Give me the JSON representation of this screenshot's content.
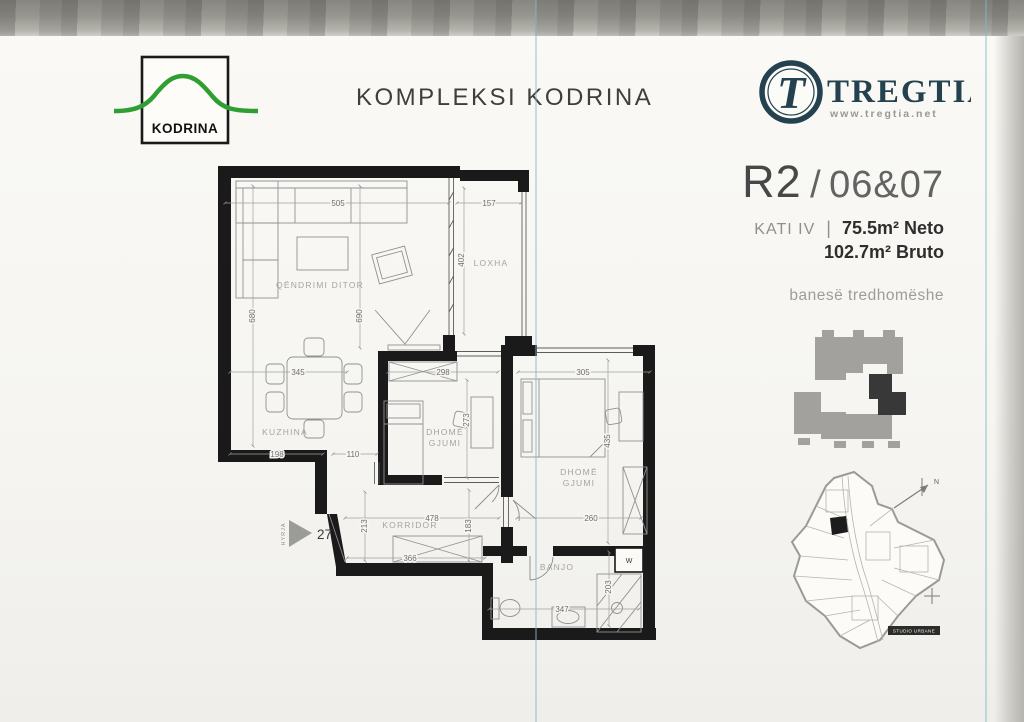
{
  "colors": {
    "logo_green": "#2f9e33",
    "tregtia_navy": "#23414e",
    "wall_black": "#1a1a1a",
    "label_gray": "#a4a4a4",
    "dim_gray": "#6e6e6e",
    "keyplan_gray": "#a2a19e",
    "keyplan_dark": "#383838"
  },
  "header": {
    "kodrina_logo": "KODRINA",
    "title": "KOMPLEKSI KODRINA",
    "tregtia": {
      "monogram": "T",
      "name": "TREGTIA",
      "url": "www.tregtia.net"
    }
  },
  "unit": {
    "block": "R2",
    "separator": "/",
    "numbers": "06&07",
    "floor": "KATI IV",
    "divider": "|",
    "neto": "75.5m² Neto",
    "bruto": "102.7m² Bruto",
    "type": "banesë tredhomëshe"
  },
  "plan": {
    "rooms": {
      "living": "QËNDRIMI DITOR",
      "loxha": "LOXHA",
      "kitchen": "KUZHINA",
      "bedroom1_l1": "DHOMË",
      "bedroom1_l2": "GJUMI",
      "bedroom2_l1": "DHOMË",
      "bedroom2_l2": "GJUMI",
      "corridor": "KORRIDOR",
      "bath": "BANJO",
      "entry": "HYRJA",
      "entry_number": "27",
      "washer": "W"
    },
    "dims": {
      "living_top": "505",
      "loxha_top": "157",
      "loxha_height": "402",
      "living_left": "680",
      "living_mid": "690",
      "dining": "345",
      "bed1_top": "298",
      "bed1_height": "273",
      "bed2_top": "305",
      "bed2_height": "435",
      "kitchen_bottom": "198",
      "passage": "110",
      "corridor_top": "478",
      "bed2_bottom": "260",
      "entry_height": "213",
      "corridor_height": "183",
      "corridor_bottom": "366",
      "bath_bottom": "347",
      "bath_right": "203"
    }
  },
  "siteplan": {
    "studio_label": "STUDIO URBANE",
    "north": "N"
  }
}
